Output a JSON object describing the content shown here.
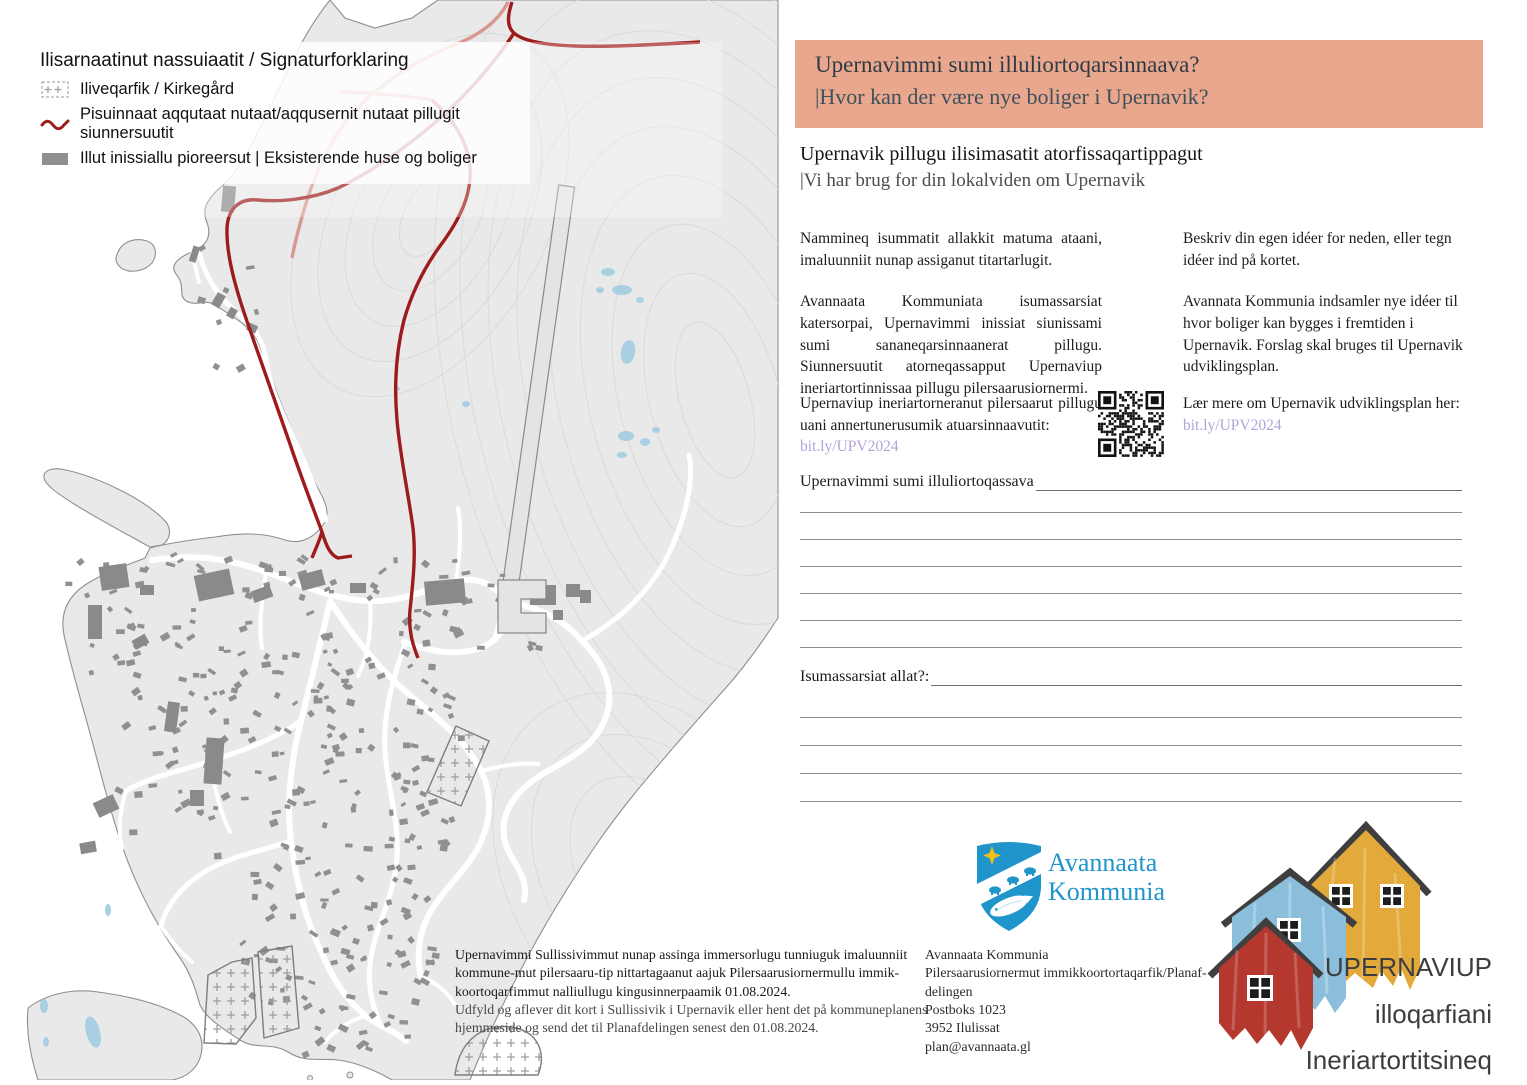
{
  "legend": {
    "title": "Ilisarnaatinut nassuiaatit / Signaturforklaring",
    "items": [
      {
        "icon": "cemetery-swatch",
        "label": "Iliveqarfik / Kirkegård"
      },
      {
        "icon": "proposed-path-line",
        "label": "Pisuinnaat aqqutaat nutaat/aqqusernit nutaat pillugit siunnersuutit"
      },
      {
        "icon": "existing-buildings-swatch",
        "label": "Illut inissiallu pioreersut | Eksisterende huse og boliger"
      }
    ]
  },
  "header": {
    "title_kl": "Upernavimmi sumi illuliortoqarsinnaava?",
    "title_da": "|Hvor kan der være nye boliger i Upernavik?",
    "bg_color": "#e9a78e"
  },
  "intro": {
    "title_kl": "Upernavik pillugu ilisimasatit atorfissaqartippagut",
    "title_da": "|Vi har brug for din lokalviden om Upernavik"
  },
  "columns": {
    "left_p1": "Nammineq isummatit allakkit matuma ataani, imaluunniit nunap assiganut titartarlugit.",
    "left_p2": "Avannaata Kommuniata isumassarsiat katersorpai, Upernavimmi inissiat siunissami sumi sananeqarsinnaanerat pillugu. Siunnersuutit atorneqassapput Upernaviup ineriartortinnissaa pillugu pilersaarusiornermi.",
    "right_p1": "Beskriv din egen idéer for neden, eller tegn idéer ind på kortet.",
    "right_p2": "Avannata Kommunia indsamler nye idéer til hvor boliger kan bygges i fremtiden i Upernavik. Forslag skal bruges til Upernavik udviklingsplan."
  },
  "qr_section": {
    "left_text": "Upernaviup ineriartorneranut pilersaarut pillugu uani annertunerusumik atuarsinnaavutit:",
    "left_link": "bit.ly/UPV2024",
    "right_text": "Lær mere om Upernavik udviklingsplan her:",
    "right_link": "bit.ly/UPV2024",
    "link_color": "#b3a3d9"
  },
  "form": {
    "q1_label": "Upernavimmi sumi illuliortoqassava",
    "q1_lines": 6,
    "q2_label": "Isumassarsiat allat?:",
    "q2_lines": 4
  },
  "footer": {
    "submit_kl": "Upernavimmi Sullissivimmut nunap assinga immersorlugu tunniuguk imaluunniit kommune-mut pilersaaru-tip nittartagaanut aajuk Pilersaarusiornermullu immik-koortoqarfimmut nalliullugu kingusinnerpaamik 01.08.2024.",
    "submit_da": "Udfyld og aflever dit kort i Sullissivik i Upernavik eller hent det på kommuneplanens hjemmeside og send det til Planafdelingen senest den 01.08.2024.",
    "address_lines": [
      "Avannaata Kommunia",
      "Pilersaarusiornermut immikkoortortaqarfik/Planaf-",
      "delingen",
      "Postboks 1023",
      "3952 Ilulissat",
      "plan@avannaata.gl"
    ]
  },
  "org": {
    "name_line1": "Avannaata",
    "name_line2": "Kommunia",
    "brand_blue": "#2095cc"
  },
  "project_logo": {
    "line1": "UPERNAVIUP",
    "line2": "illoqarfiani",
    "line3": "Ineriartortitsineq",
    "house_red": "#b5382e",
    "house_blue": "#8abedb",
    "house_yellow": "#e3a93b"
  },
  "map_colors": {
    "land": "#e9e9e9",
    "proposed_red": "#9e1b1b",
    "proposed_pink": "#d9978f",
    "water": "#a9cfe2",
    "buildings": "#8f8f8f"
  }
}
